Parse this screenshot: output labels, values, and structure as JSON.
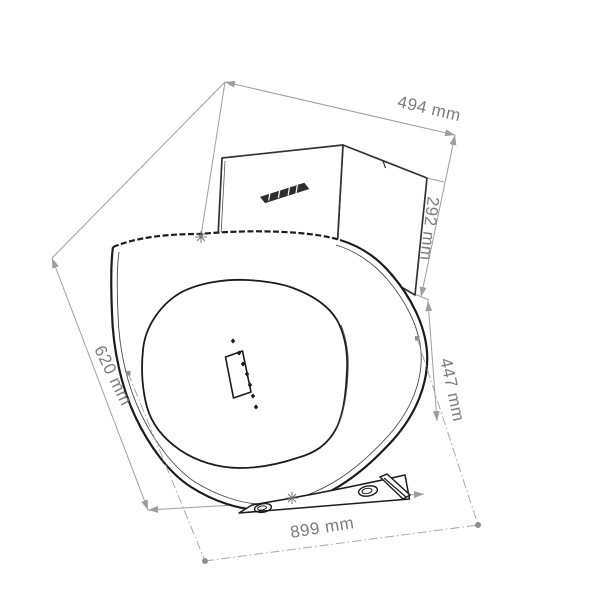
{
  "page": {
    "type": "technical dimension drawing",
    "background": "#ffffff"
  },
  "product": {
    "subject": "wall-mounted inclined cooker hood, front-left perspective line drawing",
    "brand_logo": "illegible italic brand mark on chimney front",
    "control_panel": {
      "display": "rectangular display window",
      "touch_buttons_count": 7
    },
    "mounting_base": {
      "slots_count": 2
    }
  },
  "dimensions": {
    "top_depth": {
      "label": "494 mm",
      "value": 494,
      "unit": "mm"
    },
    "chimney_height": {
      "label": "292 mm",
      "value": 292,
      "unit": "mm"
    },
    "front_panel_height": {
      "label": "620 mm",
      "value": 620,
      "unit": "mm"
    },
    "right_side_height": {
      "label": "447 mm",
      "value": 447,
      "unit": "mm"
    },
    "bottom_width": {
      "label": "899 mm",
      "value": 899,
      "unit": "mm"
    }
  },
  "colors": {
    "outline": "#222222",
    "dimension_line": "#9e9e9e",
    "label_text": "#7c7c7c",
    "centerline": "#a8a8a8",
    "background": "#ffffff"
  }
}
